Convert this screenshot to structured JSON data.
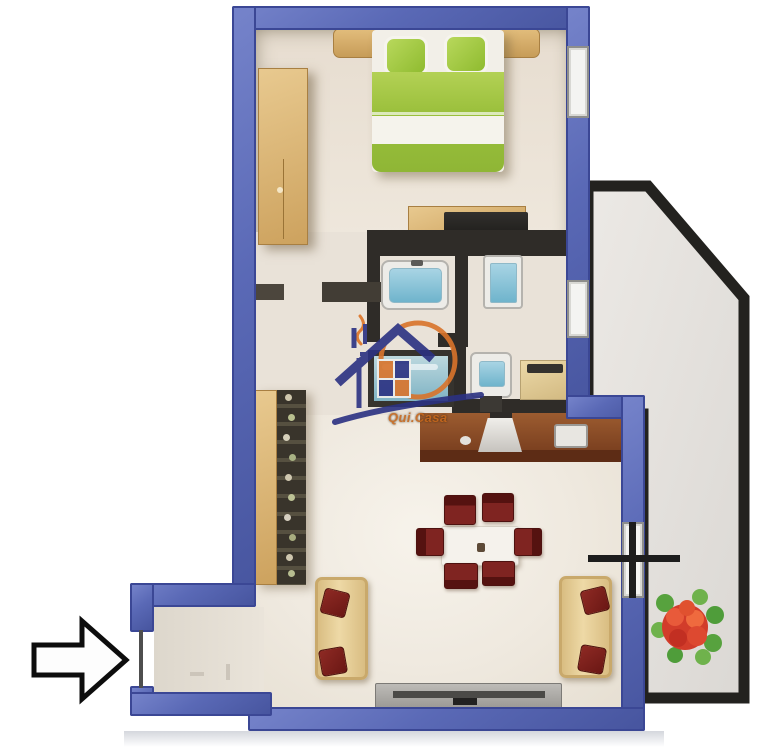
{
  "meta": {
    "type": "3d-floor-plan",
    "width_px": 784,
    "height_px": 753
  },
  "watermark": {
    "brand_text": "Qui.Casa",
    "logo": "house-with-circle-logo",
    "orange": "#d9742b",
    "navy": "#2b3182"
  },
  "symbols": {
    "entrance_arrow": "right-arrow-outline",
    "window_marker": "cross-mark"
  },
  "palette": {
    "exterior_wall_blue": "#5a69b6",
    "interior_wall_dark": "#2f2c28",
    "balcony_wall_black": "#23221f",
    "floor_cream": "#efe8dd",
    "wood_beige": "#d9b26e",
    "bed_green": "#a8cc4e",
    "chair_red": "#7d2220",
    "kitchen_brown": "#8a4c27",
    "console_gray": "#a3a19d",
    "bath_water_blue": "#7fb9d0",
    "flower_red": "#d23c2a",
    "leaf_green": "#57a23e"
  }
}
